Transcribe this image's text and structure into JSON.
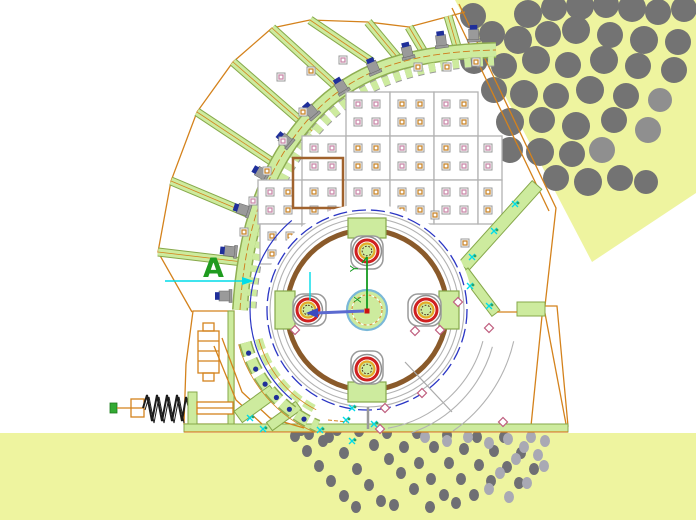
{
  "meta": {
    "type": "cad-drawing",
    "subject": "hammer-crusher cross-section with rock feed and discharge"
  },
  "labels": {
    "datum_a": "A",
    "axis_y": "Y",
    "axis_x": "X"
  },
  "colors": {
    "background": "#ffffff",
    "feed_fill": "#eef49f",
    "rock_gray": "#737373",
    "rock_light": "#8f8f8f",
    "particle_dark": "#6f6f74",
    "particle_light": "#a9a9b4",
    "green_fill": "#cdeb9e",
    "green_edge": "#86a84a",
    "orange": "#d4821c",
    "panel_edge": "#b2b2b2",
    "pink": "#c989a9",
    "square_orange": "#c8862c",
    "blue": "#2a35c4",
    "bolt_cap_blue": "#1f2f9a",
    "bolt_gray": "#9a9a9a",
    "cyan": "#00dce8",
    "red": "#cf2020",
    "ring_yellow": "#e3ac28",
    "brown": "#8a5a2a",
    "gray_line": "#aaaaaa",
    "ucs_green": "#149b1f"
  },
  "regions": {
    "feed_chute_polygon": "455,0 696,0 696,193 592,262",
    "discharge_area": {
      "x": 0,
      "y": 433,
      "w": 696,
      "h": 87
    }
  },
  "rocks": {
    "points": [
      [
        473,
        16,
        13
      ],
      [
        528,
        14,
        14
      ],
      [
        554,
        8,
        13
      ],
      [
        580,
        6,
        14
      ],
      [
        606,
        5,
        13
      ],
      [
        632,
        8,
        14
      ],
      [
        658,
        12,
        13
      ],
      [
        684,
        9,
        13
      ],
      [
        492,
        34,
        13
      ],
      [
        518,
        40,
        14
      ],
      [
        548,
        34,
        13
      ],
      [
        576,
        30,
        14
      ],
      [
        610,
        35,
        13
      ],
      [
        644,
        40,
        14
      ],
      [
        678,
        42,
        13
      ],
      [
        474,
        60,
        14
      ],
      [
        504,
        66,
        13
      ],
      [
        536,
        60,
        14
      ],
      [
        568,
        65,
        13
      ],
      [
        604,
        60,
        14
      ],
      [
        638,
        66,
        13
      ],
      [
        674,
        70,
        13
      ],
      [
        494,
        90,
        13
      ],
      [
        524,
        94,
        14
      ],
      [
        556,
        96,
        13
      ],
      [
        590,
        90,
        14
      ],
      [
        626,
        96,
        13
      ],
      [
        510,
        122,
        14
      ],
      [
        542,
        120,
        13
      ],
      [
        576,
        126,
        14
      ],
      [
        614,
        120,
        13
      ],
      [
        510,
        150,
        13
      ],
      [
        540,
        152,
        14
      ],
      [
        572,
        154,
        13
      ],
      [
        556,
        178,
        13
      ],
      [
        588,
        182,
        14
      ],
      [
        620,
        178,
        13
      ],
      [
        646,
        182,
        12
      ]
    ],
    "light_points": [
      [
        660,
        100,
        12
      ],
      [
        648,
        130,
        13
      ],
      [
        602,
        150,
        13
      ]
    ]
  },
  "particles": {
    "r": 5,
    "dark": [
      [
        295,
        436
      ],
      [
        307,
        451
      ],
      [
        319,
        466
      ],
      [
        331,
        481
      ],
      [
        344,
        496
      ],
      [
        301,
        430
      ],
      [
        309,
        434
      ],
      [
        323,
        441
      ],
      [
        337,
        430
      ],
      [
        329,
        437
      ],
      [
        344,
        453
      ],
      [
        357,
        469
      ],
      [
        369,
        485
      ],
      [
        381,
        501
      ],
      [
        359,
        431
      ],
      [
        374,
        445
      ],
      [
        389,
        459
      ],
      [
        401,
        473
      ],
      [
        414,
        489
      ],
      [
        387,
        433
      ],
      [
        404,
        447
      ],
      [
        419,
        463
      ],
      [
        431,
        479
      ],
      [
        444,
        495
      ],
      [
        417,
        433
      ],
      [
        434,
        447
      ],
      [
        449,
        463
      ],
      [
        461,
        479
      ],
      [
        474,
        495
      ],
      [
        447,
        435
      ],
      [
        464,
        449
      ],
      [
        479,
        465
      ],
      [
        491,
        481
      ],
      [
        477,
        437
      ],
      [
        494,
        451
      ],
      [
        507,
        467
      ],
      [
        519,
        483
      ],
      [
        504,
        437
      ],
      [
        521,
        453
      ],
      [
        534,
        469
      ],
      [
        356,
        507
      ],
      [
        394,
        505
      ],
      [
        430,
        507
      ],
      [
        456,
        503
      ]
    ],
    "light": [
      [
        425,
        437
      ],
      [
        447,
        441
      ],
      [
        468,
        437
      ],
      [
        489,
        443
      ],
      [
        508,
        439
      ],
      [
        524,
        447
      ],
      [
        538,
        455
      ],
      [
        531,
        437
      ],
      [
        516,
        459
      ],
      [
        544,
        466
      ],
      [
        500,
        473
      ],
      [
        489,
        489
      ],
      [
        509,
        497
      ],
      [
        527,
        483
      ],
      [
        545,
        441
      ]
    ]
  },
  "ribs": [
    [
      158,
      252,
      243,
      262
    ],
    [
      171,
      181,
      259,
      218
    ],
    [
      197,
      112,
      283,
      169
    ],
    [
      233,
      62,
      312,
      131
    ],
    [
      272,
      28,
      349,
      98
    ],
    [
      310,
      20,
      372,
      62
    ],
    [
      368,
      22,
      398,
      58
    ],
    [
      409,
      27,
      425,
      54
    ],
    [
      448,
      16,
      458,
      50
    ]
  ],
  "band_bolts": [
    [
      232,
      296,
      -90
    ],
    [
      237,
      252,
      -84
    ],
    [
      250,
      212,
      -72
    ],
    [
      268,
      177,
      -60
    ],
    [
      291,
      145,
      -50
    ],
    [
      316,
      117,
      -41
    ],
    [
      345,
      93,
      -32
    ],
    [
      376,
      74,
      -23
    ],
    [
      409,
      59,
      -14
    ],
    [
      442,
      48,
      -7
    ],
    [
      474,
      42,
      -2
    ]
  ],
  "panels": {
    "cells": [
      [
        346,
        92,
        44,
        44
      ],
      [
        390,
        92,
        44,
        44
      ],
      [
        434,
        92,
        44,
        44
      ],
      [
        302,
        136,
        44,
        44
      ],
      [
        346,
        136,
        44,
        44
      ],
      [
        390,
        136,
        44,
        44
      ],
      [
        434,
        136,
        44,
        44
      ],
      [
        478,
        136,
        24,
        44
      ],
      [
        258,
        180,
        44,
        44
      ],
      [
        302,
        180,
        44,
        44
      ],
      [
        346,
        180,
        44,
        44
      ],
      [
        390,
        180,
        44,
        44
      ],
      [
        434,
        180,
        44,
        44
      ],
      [
        478,
        180,
        24,
        44
      ],
      [
        260,
        224,
        42,
        40
      ],
      [
        302,
        224,
        42,
        40
      ]
    ],
    "highlight": [
      293,
      158,
      50,
      50
    ]
  },
  "squares": [
    [
      303,
      112,
      "o"
    ],
    [
      283,
      141,
      "p"
    ],
    [
      267,
      171,
      "o"
    ],
    [
      253,
      201,
      "p"
    ],
    [
      244,
      232,
      "o"
    ],
    [
      281,
      77,
      "p"
    ],
    [
      311,
      71,
      "o"
    ],
    [
      343,
      60,
      "p"
    ],
    [
      418,
      67,
      "o"
    ],
    [
      447,
      67,
      "o"
    ],
    [
      476,
      62,
      "o"
    ],
    [
      435,
      215,
      "o"
    ],
    [
      437,
      243,
      "o"
    ],
    [
      465,
      243,
      "o"
    ]
  ],
  "hammers": {
    "cx": 367,
    "cy": 310,
    "angles": [
      0,
      90,
      180,
      270
    ]
  },
  "grate_bolts": [
    [
      248.6,
      353.1
    ],
    [
      255.7,
      369.1
    ],
    [
      265.1,
      384.1
    ],
    [
      276.4,
      397.5
    ],
    [
      289.4,
      409.3
    ],
    [
      304,
      419.1
    ]
  ],
  "diamonds": [
    [
      385,
      408
    ],
    [
      422,
      393
    ],
    [
      380,
      429
    ],
    [
      458,
      302
    ],
    [
      489,
      328
    ],
    [
      503,
      422
    ],
    [
      415,
      331
    ],
    [
      295,
      330
    ],
    [
      440,
      330
    ]
  ],
  "cyan_marks": [
    [
      250,
      418
    ],
    [
      263,
      429
    ],
    [
      320,
      430
    ],
    [
      352,
      441
    ],
    [
      374,
      424
    ],
    [
      352,
      408
    ],
    [
      346,
      420
    ],
    [
      515,
      204
    ],
    [
      494,
      231
    ],
    [
      472,
      257
    ],
    [
      470,
      286
    ],
    [
      489,
      306
    ]
  ]
}
